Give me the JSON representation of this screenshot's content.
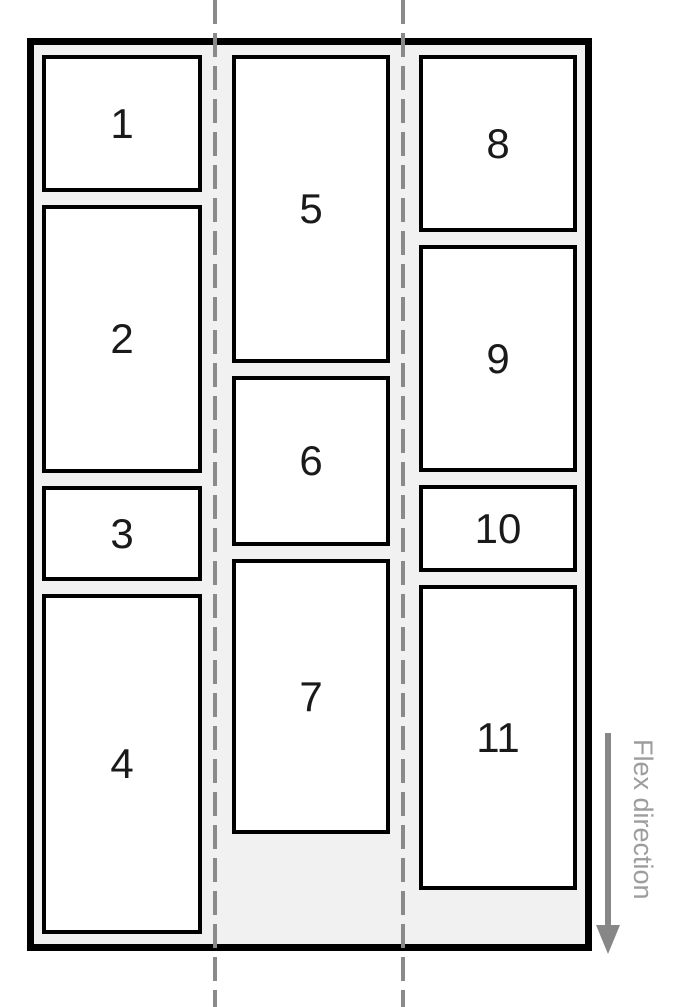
{
  "diagram": {
    "description": "flex-wrap column diagram",
    "columns": [
      {
        "name": "column-1",
        "items": [
          "1",
          "2",
          "3",
          "4"
        ]
      },
      {
        "name": "column-2",
        "items": [
          "5",
          "6",
          "7"
        ]
      },
      {
        "name": "column-3",
        "items": [
          "8",
          "9",
          "10",
          "11"
        ]
      }
    ],
    "annotation": {
      "label": "Flex direction",
      "direction": "down"
    },
    "colors": {
      "page_background": "#ffffff",
      "container_border": "#000000",
      "container_background": "#f1f1f1",
      "item_background": "#ffffff",
      "item_border": "#000000",
      "item_text": "#1a1a1a",
      "dashed_guide": "#8a8a8a",
      "arrow": "#878787",
      "annotation_text": "#9d9d9d"
    }
  }
}
